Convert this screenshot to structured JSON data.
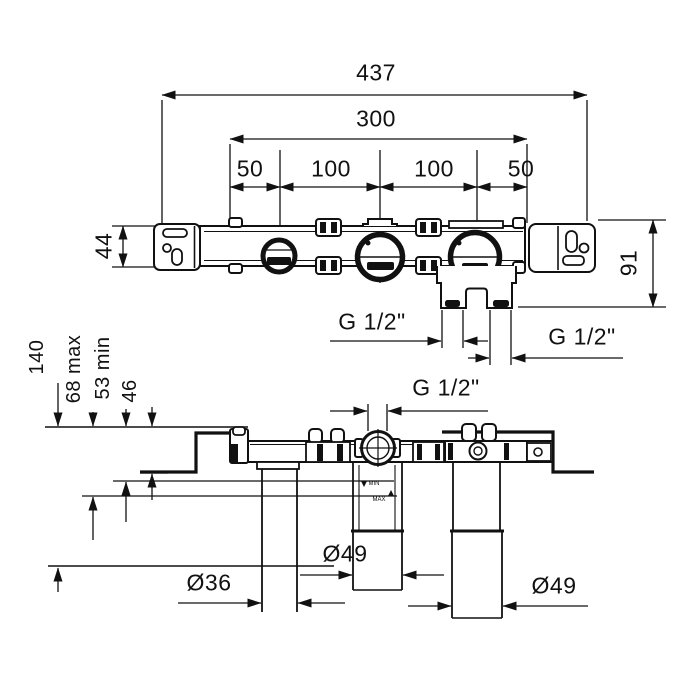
{
  "drawing": {
    "kind": "concealed thermostatic shower valve installation dimensions",
    "colors": {
      "line": "#111111",
      "background": "#ffffff"
    },
    "top_view": {
      "overall_width": "437",
      "mounting_width": "300",
      "spacings": [
        "50",
        "100",
        "100",
        "50"
      ],
      "body_height": "44",
      "total_height": "91",
      "outlet_thread_left": "G 1/2\"",
      "outlet_thread_right": "G 1/2\""
    },
    "bottom_view": {
      "total_depth": "140",
      "plaster_depth_max": "68 max",
      "plaster_depth_min": "53 min",
      "bracket_depth": "46",
      "top_port_thread": "G 1/2\"",
      "min_mark": "MIN",
      "max_mark": "MAX",
      "pipe_dia_left": "Ø36",
      "pipe_dia_middle": "Ø49",
      "pipe_dia_right": "Ø49"
    }
  }
}
